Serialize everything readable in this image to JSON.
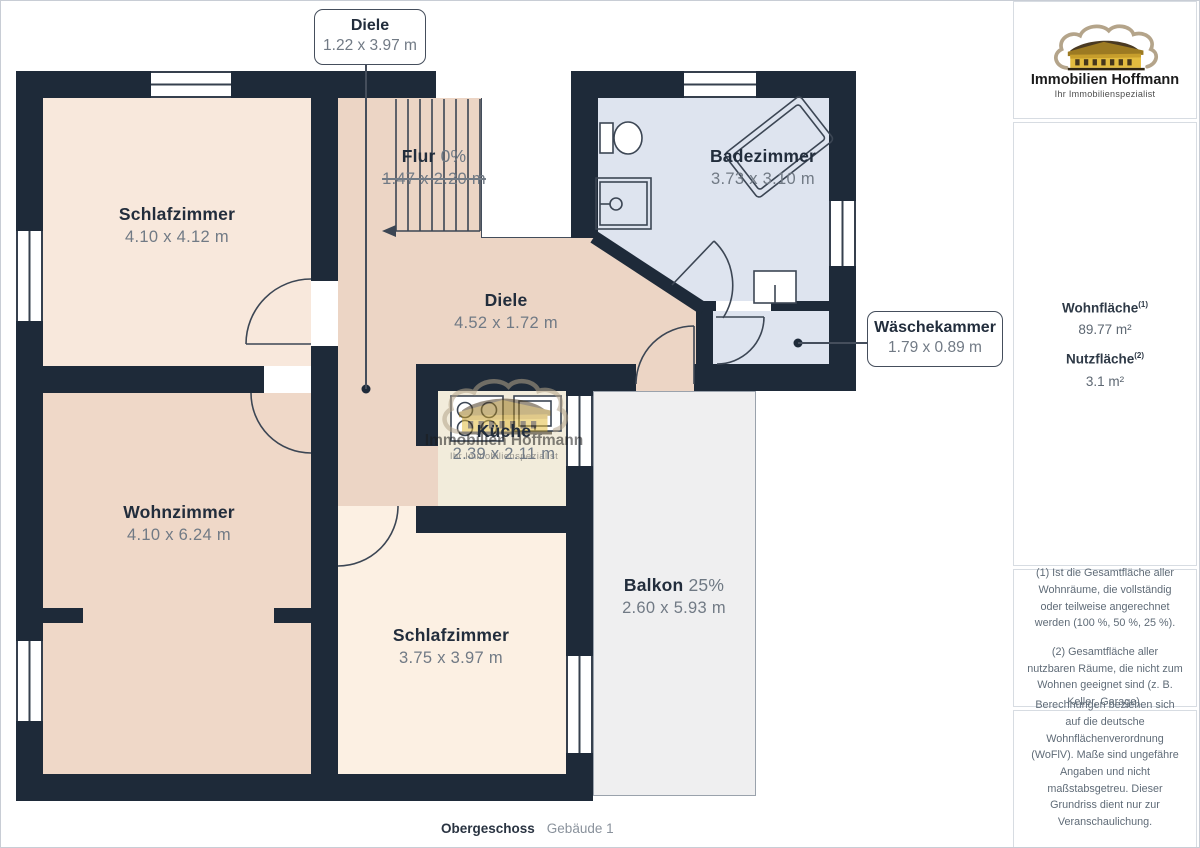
{
  "branding": {
    "name": "Immobilien Hoffmann",
    "tagline": "Ihr Immobilienspezialist"
  },
  "page": {
    "floor_label": "Obergeschoss",
    "building_label": "Gebäude 1"
  },
  "rooms": [
    {
      "id": "schlafzimmer-1",
      "name": "Schlafzimmer",
      "suffix": "",
      "dims": "4.10 x 4.12 m"
    },
    {
      "id": "flur",
      "name": "Flur",
      "suffix": "0%",
      "dims": "1.47 x 2.20 m",
      "dims_struck": true
    },
    {
      "id": "badezimmer",
      "name": "Badezimmer",
      "suffix": "",
      "dims": "3.73 x 3.10 m"
    },
    {
      "id": "diele",
      "name": "Diele",
      "suffix": "",
      "dims": "4.52 x 1.72 m"
    },
    {
      "id": "kueche",
      "name": "Küche",
      "suffix": "",
      "dims": "2.39 x 2.11 m"
    },
    {
      "id": "wohnzimmer",
      "name": "Wohnzimmer",
      "suffix": "",
      "dims": "4.10 x 6.24 m"
    },
    {
      "id": "schlafzimmer-2",
      "name": "Schlafzimmer",
      "suffix": "",
      "dims": "3.75 x 3.97 m"
    },
    {
      "id": "balkon",
      "name": "Balkon",
      "suffix": "25%",
      "dims": "2.60 x 5.93 m"
    }
  ],
  "callouts": [
    {
      "id": "diele-callout",
      "name": "Diele",
      "dims": "1.22 x 3.97 m"
    },
    {
      "id": "waeschekammer-callout",
      "name": "Wäschekammer",
      "dims": "1.79 x 0.89 m"
    }
  ],
  "sidebar": {
    "stats": [
      {
        "label": "Wohnfläche",
        "sup": "(1)",
        "value": "89.77 m²"
      },
      {
        "label": "Nutzfläche",
        "sup": "(2)",
        "value": "3.1 m²"
      }
    ],
    "footnotes": [
      "(1) Ist die Gesamtfläche aller Wohnräume, die vollständig oder teilweise angerechnet werden (100 %, 50 %, 25 %).",
      "(2) Gesamtfläche aller nutzbaren Räume, die nicht zum Wohnen geeignet sind (z. B. Keller, Garage)."
    ],
    "disclaimer": "Berechnungen beziehen sich auf die deutsche Wohnflächenverordnung (WoFlV). Maße sind ungefähre Angaben und nicht maßstabsgetreu. Dieser Grundriss dient nur zur Veranschaulichung.",
    "brand_footer": {
      "giraffe": "GIRAFFE",
      "threesixty": "360"
    }
  },
  "colors": {
    "wall": "#1e2a39",
    "schlafzimmer_1": "#f8e8dc",
    "corridor": "#ecd5c5",
    "wohnzimmer": "#efd8c8",
    "schlafzimmer_2": "#fcf0e3",
    "kueche": "#f2ecdb",
    "bad": "#dee4ef",
    "balkon": "#efeff0",
    "brand_gold": "#e3bc3f"
  }
}
